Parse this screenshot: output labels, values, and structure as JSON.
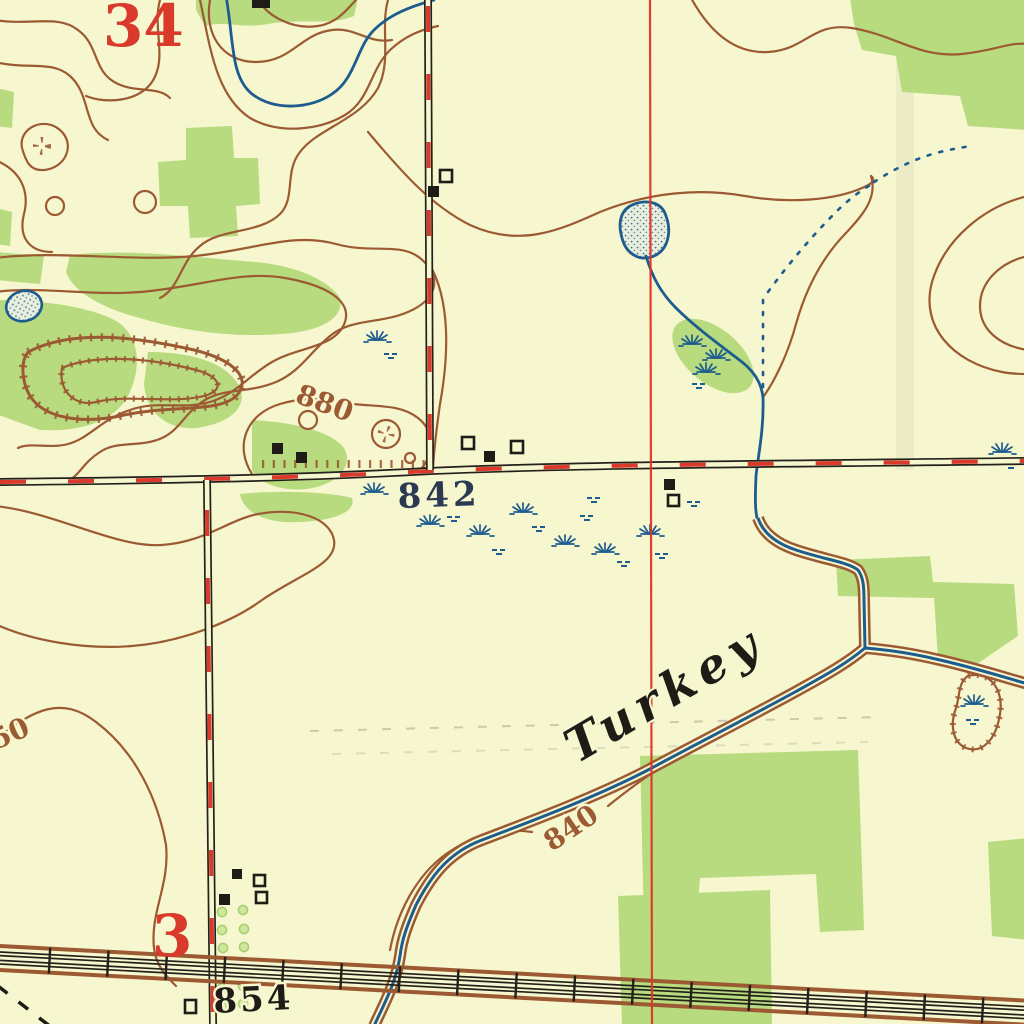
{
  "map": {
    "type": "usgs-topographic-quad-excerpt",
    "labels": {
      "section_number_top_left": "34",
      "section_number_bottom_left": "3",
      "contour_hill": "880",
      "contour_creek": "840",
      "contour_left_edge_partial": "50",
      "spot_elevation_road": "842",
      "spot_elevation_railroad": "854",
      "creek_name": "Turkey"
    },
    "colors": {
      "paper": "#f6f6cf",
      "woodland_green": "#b7db7e",
      "contour_brown": "#9c5a33",
      "water_blue": "#1d5c8e",
      "overprint_red": "#d93a2c",
      "ink_black": "#1f1c17"
    },
    "symbols": [
      "contour-lines",
      "depression-contours-hachured",
      "intermittent-pond",
      "intermittent-stream",
      "marsh-tufts",
      "drainage-ditch",
      "improved-road-red-dash",
      "section-line-red",
      "railroad-multitrack",
      "buildings-filled-and-hollow",
      "orchard-dots",
      "woodland-tint"
    ]
  }
}
